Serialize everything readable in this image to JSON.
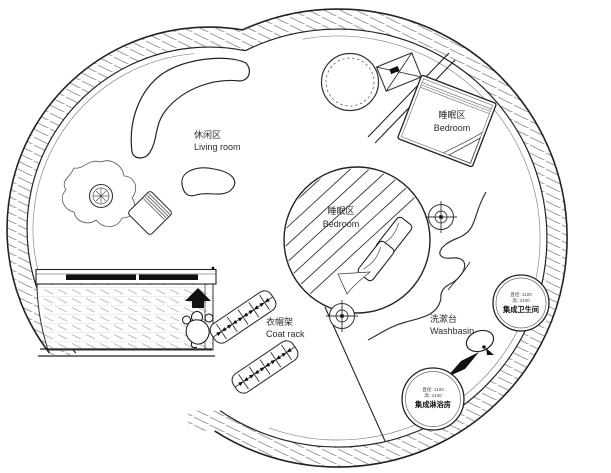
{
  "plan": {
    "type": "circular tiny-house floor plan",
    "labels": {
      "living_room": {
        "zh": "休闲区",
        "en": "Living room"
      },
      "bedroom_upper": {
        "zh": "睡眠区",
        "en": "Bedroom"
      },
      "bedroom_center": {
        "zh": "睡眠区",
        "en": "Bedroom"
      },
      "coat_rack": {
        "zh": "衣帽架",
        "en": "Coat rack"
      },
      "washbasin": {
        "zh": "洗漱台",
        "en": "Washbasin"
      }
    },
    "pods": {
      "bathroom": {
        "dim_diameter": "直径: 1100",
        "dim_height": "高: 2100",
        "name": "集成卫生间"
      },
      "shower": {
        "dim_diameter": "直径: 1100",
        "dim_height": "高: 2100",
        "name": "集成淋浴房"
      }
    },
    "colors": {
      "line": "#2b2b2b",
      "wall_hatch": "#a6a6a6",
      "terrace_hatch": "#b3b3b3",
      "background": "#ffffff"
    }
  }
}
